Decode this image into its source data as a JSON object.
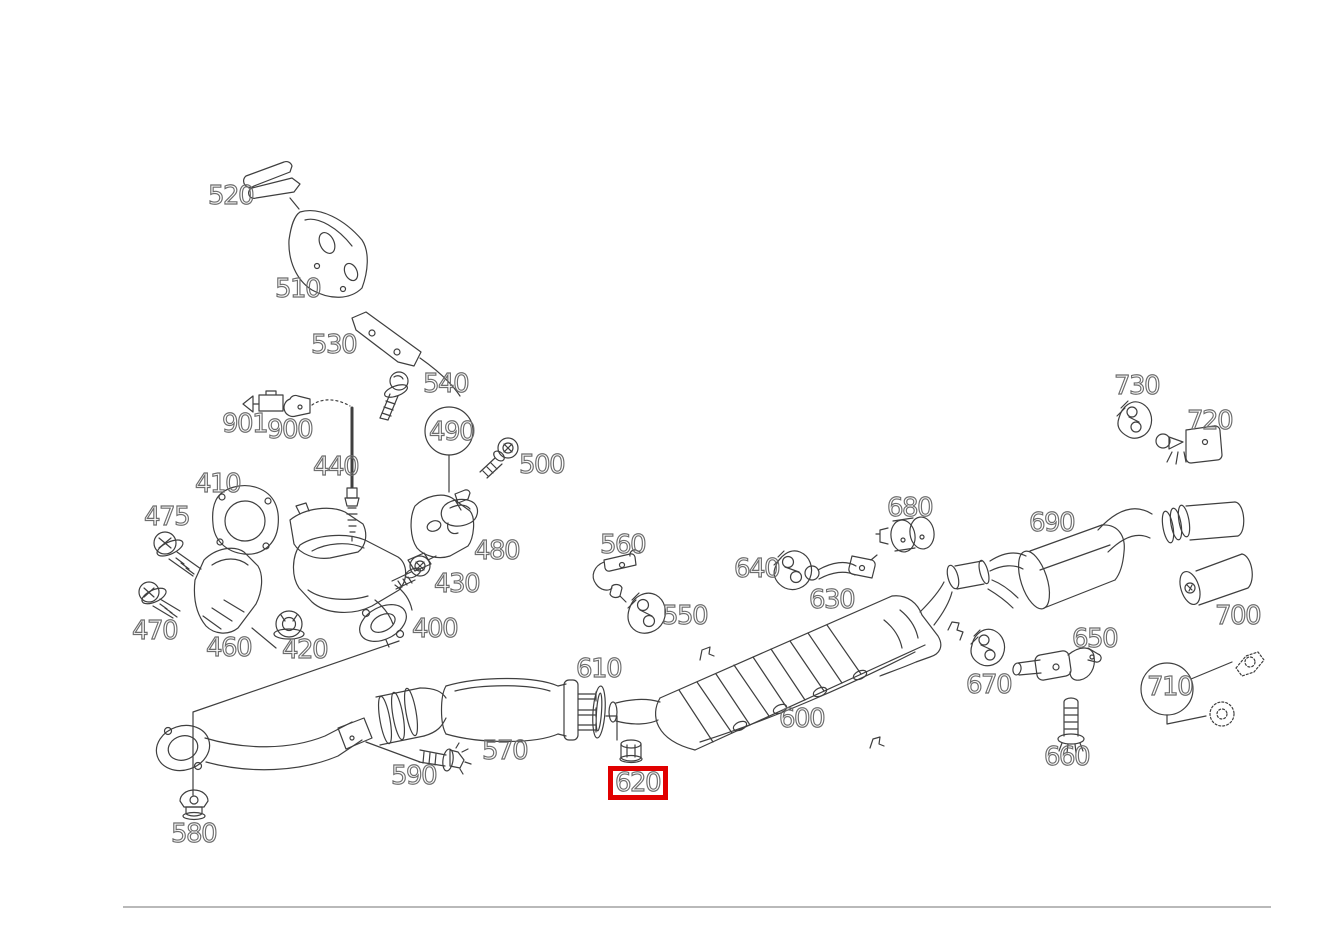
{
  "labels": {
    "n400": "400",
    "n410": "410",
    "n420": "420",
    "n430": "430",
    "n440": "440",
    "n460": "460",
    "n470": "470",
    "n475": "475",
    "n480": "480",
    "n490": "490",
    "n500": "500",
    "n510": "510",
    "n520": "520",
    "n530": "530",
    "n540": "540",
    "n550": "550",
    "n560": "560",
    "n570": "570",
    "n580": "580",
    "n590": "590",
    "n600": "600",
    "n610": "610",
    "n620": "620",
    "n630": "630",
    "n640": "640",
    "n650": "650",
    "n660": "660",
    "n670": "670",
    "n680": "680",
    "n690": "690",
    "n700": "700",
    "n710": "710",
    "n720": "720",
    "n730": "730",
    "n900": "900",
    "n901": "901"
  },
  "highlight": {
    "part": "620",
    "color": "#e10000"
  },
  "colors": {
    "line_art": "#3f3f3f",
    "label_outline": "#6d6d6d",
    "highlight_box": "#e10000",
    "divider": "#b9b9b9"
  }
}
